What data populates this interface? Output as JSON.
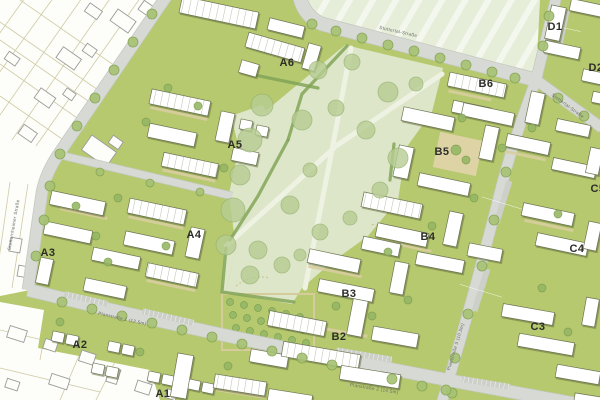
{
  "map": {
    "type": "urban-masterplan-site-plan",
    "region_labels": [
      {
        "id": "A1"
      },
      {
        "id": "A2"
      },
      {
        "id": "A3"
      },
      {
        "id": "A4"
      },
      {
        "id": "A5"
      },
      {
        "id": "A6"
      },
      {
        "id": "B2"
      },
      {
        "id": "B3"
      },
      {
        "id": "B4"
      },
      {
        "id": "B5"
      },
      {
        "id": "B6"
      },
      {
        "id": "C3"
      },
      {
        "id": "C4"
      },
      {
        "id": "C5"
      },
      {
        "id": "D1"
      },
      {
        "id": "D2"
      }
    ],
    "street_labels": [
      {
        "name": "Stottertal-Straße"
      },
      {
        "name": "Stottertal-Straße"
      },
      {
        "name": "Stotternheimer Straße"
      },
      {
        "name": "Planstraße 1 (12.5m)"
      },
      {
        "name": "Planstraße 2 (14.5m)"
      },
      {
        "name": "Planstraße 3 (10.5m)"
      }
    ],
    "colors": {
      "development_green": "#b6c96f",
      "park_green": "#dde6c8",
      "field_green": "#e6eed9",
      "road_gray": "#d7dad4",
      "building_fill": "#ffffff",
      "building_outline": "#6b7452",
      "building_shadow": "#5a6438",
      "street_tree_green": "#a6c273",
      "park_tree_green": "#b7cd93",
      "path_beige": "#d8cd9e",
      "plaza_beige": "#ded3a4",
      "existing_area_white": "#fdfdf9",
      "existing_outline_gray": "#9b9b9b",
      "parcel_line_tan": "#cfcaa4",
      "hedge_green": "#83a558",
      "label_dark": "#2d2d28",
      "street_label_gray": "#6b6b66"
    }
  }
}
